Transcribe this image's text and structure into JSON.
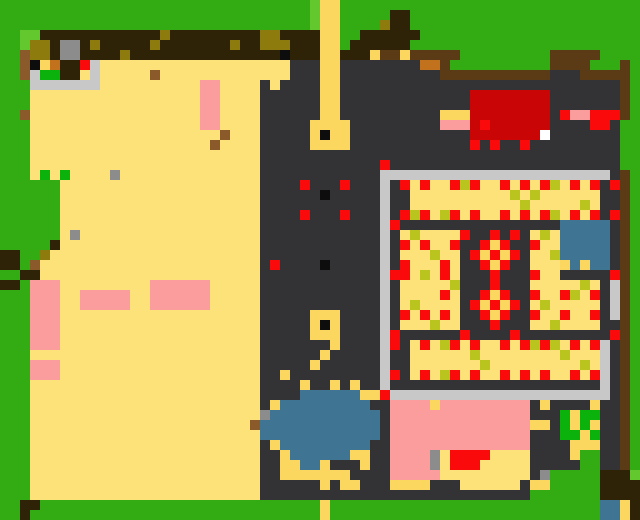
{
  "map": {
    "width_px": 640,
    "height_px": 520,
    "tile_size": 10,
    "cols": 64,
    "rows": 52,
    "palette": {
      "G": "#33ab13",
      "L": "#63c82e",
      "V": "#0cb20c",
      "T": "#fde179",
      "Y": "#fcd760",
      "D": "#333235",
      "B": "#2e2307",
      "b": "#5b3a16",
      "N": "#8a5a2b",
      "o": "#c2711d",
      "O": "#8d7b0d",
      "v": "#b9c41f",
      "P": "#fb9d9d",
      "R": "#fa0a0a",
      "r": "#c90505",
      "K": "#0d0d0d",
      "S": "#c8c8c8",
      "s": "#8c8c8c",
      "U": "#3f7492",
      "W": "#ffffff"
    },
    "legend": {
      "G": "grass",
      "L": "light-grass",
      "V": "bright-green-bush",
      "T": "sand-field",
      "Y": "yellow-path",
      "D": "dark-plaza-ground",
      "B": "dark-brown-wood",
      "b": "brown-fence",
      "N": "brown-debris",
      "o": "orange-crate",
      "O": "olive-thatch",
      "v": "olive-crop-speckle",
      "P": "pink-roof",
      "R": "red-marker",
      "r": "red-roof-building",
      "K": "black-marker",
      "S": "silver-wall",
      "s": "gray-stone",
      "U": "water",
      "W": "white-dot"
    },
    "rows_rle": [
      "G31 L Y2 G30",
      "G31 L Y2 G5 B2 G23",
      "G31 L Y2 G4 O B2 G23",
      "G2 L2 B12 O B9 O2 B4 Y2 G2 B6 G22",
      "G2 L O2 B s2 B O B5 O B7 O B2 O3 B3 Y2 G B6 G23",
      "G2 N O2 B s2 B4 O B15 K B3 Y2 B3 Y b2 Y b5 G9 b5 G4",
      "G2 N K Y o B2 R S T19 D3 Y2 D8 o2 b G10 b4 G3 b G",
      "G2 N S V2 B2 T S T5 N T13 D3 Y2 D10 b11 D3 b5 G",
      "G3 S7 T10 P2 T4 D T D4 Y2 D28 b G",
      "G3 T17 P2 T4 D6 Y2 D13 r8 D7 b G",
      "G3 T17 P2 T4 D6 Y2 D13 r8 D7 b G",
      "G2 N T17 P2 T4 D6 Y2 D10 Y3 r8 D R P2 R3 b G",
      "G3 T17 P2 T4 D5 Y4 D9 P3 r R r6 D4 R2 D G2",
      "G3 T19 N T3 D5 Y K Y2 D12 r7 W D7 G2",
      "G3 T18 N T4 D5 Y4 D12 R D R D2 R D9 G2",
      "G3 T23 D36 G2",
      "G3 T23 D12 R D23 G2",
      "G3 T V T V T4 s T14 D12 S23 D b G",
      "G6 T20 D4 R D3 R D3 S D R T R T2 R v R T2 R T R T R v T R T R D R b G",
      "G6 T20 D6 K D5 S D2 T10 v T v T6 D2 b G",
      "G6 T20 D12 S D2 T11 v T5 v T D2 b G",
      "G6 T20 D4 R D3 R D3 S D R v R T v R T R T2 R T R T R v T R T R D R b G",
      "G6 T20 D12 S R D16 U5 D b G",
      "G6 T s T18 D12 S D T v T4 R D2 R D R D T v T U5 D b G",
      "G5 B T20 D12 S D R T R T2 R D2 R Y R D2 R T2 U5 D b G",
      "B2 G2 O T21 D12 S D T3 v T2 D R Y R Y R D T2 v U5 D b G",
      "B2 G N T22 D R D4 K D5 S D R T3 R T D2 R Y R D2 T3 Y U Y U2 D b G",
      "G2 B2 T22 D12 S R R T v T R T D3 R D3 R T2 D5 R b G",
      "B2 G P3 T9 P6 T5 D12 S D T5 v D3 R D3 T5 v T D S b G",
      "G3 P3 T2 P5 T2 P6 T5 D12 S D T4 R T D2 R Y R D2 R T2 R v T R D S b G",
      "G3 P3 T2 P5 T2 P6 T5 D12 S D T v T4 D R Y R Y R D T v T5 D S b G",
      "G3 P3 T20 D5 Y3 D4 S D R T R T R T D2 R Y R D2 R T2 R T2 R D S b G",
      "G3 P3 T20 D5 Y K Y D4 S D T3 v T2 D3 R D3 T2 v T4 D2 b G",
      "G3 P3 T20 D5 Y3 D4 S R D6 R D4 R D9 R b G",
      "G3 P3 T20 D7 Y D4 S R D T R T v R T R T2 R T R v R v T R T R S D b G",
      "G3 T23 D6 Y D5 S D2 T6 v T8 v T3 S D b G",
      "G3 P3 T20 D5 Y D6 S D2 T7 v T9 v T S D b G",
      "G3 P3 T20 D2 Y D9 S R D T R T v R T R T2 R T R T R T2 R T R S D b G",
      "G3 T23 D4 Y D2 Y D Y D2 S D21 S D b G",
      "G3 T23 D4 U6 Y2 R S22 D b G",
      "G3 T23 D Y U9 D2 P4 Y P9 D Y D4 Y D2 b G",
      "G3 T23 s U11 D P14 D3 V Y V2 D2 b G",
      "G3 T22 N U12 D P14 Y2 D V Y V Y D2 b G",
      "G3 T23 U12 D P14 D3 V2 Y V D2 b G",
      "G3 T23 D Y U9 D2 P14 D4 Y3 D2 b G",
      "G3 T23 D2 Y U6 Y2 D2 P4 s T R4 T4 D4 Y G2 D2 b G",
      "G3 T23 D2 Y2 U2 Y D3 Y D2 P4 s T R3 T5 D5 G2 D2 b G",
      "G3 T23 D2 Y7 D4 P5 T9 D s G5 B3 L",
      "G3 T23 D6 Y D Y2 D3 Y4 D3 T6 D Y2 G5 B4",
      "G3 T23 D27 G7 B4",
      "G2 B2 G28 Y G27 U2 Y B",
      "G2 B G29 Y G27 U2 Y B"
    ],
    "features": [
      {
        "name": "sand-farm-field",
        "approx_px": [
          30,
          60,
          260,
          495
        ]
      },
      {
        "name": "top-dirt-ridge",
        "approx_px": [
          40,
          30,
          320,
          63
        ]
      },
      {
        "name": "stone-pen",
        "approx_px": [
          30,
          60,
          100,
          90
        ]
      },
      {
        "name": "vertical-footpath",
        "approx_px": [
          320,
          0,
          340,
          145
        ]
      },
      {
        "name": "path-waypoint-square-upper",
        "approx_px": [
          312,
          120,
          345,
          145
        ]
      },
      {
        "name": "path-waypoint-square-lower",
        "approx_px": [
          312,
          310,
          337,
          335
        ]
      },
      {
        "name": "red-black-marker-diamond",
        "approx_px": [
          295,
          175,
          353,
          218
        ]
      },
      {
        "name": "red-roof-building",
        "approx_px": [
          472,
          88,
          545,
          133
        ]
      },
      {
        "name": "red-pink-stall",
        "approx_px": [
          560,
          112,
          623,
          130
        ]
      },
      {
        "name": "walled-market-compound",
        "approx_px": [
          383,
          158,
          617,
          400
        ]
      },
      {
        "name": "crop-beds-with-red-dots",
        "approx_px": [
          400,
          177,
          600,
          378
        ]
      },
      {
        "name": "red-yellow-checker-diamonds",
        "approx_px": [
          465,
          226,
          520,
          337
        ]
      },
      {
        "name": "blue-stall-roof",
        "approx_px": [
          560,
          223,
          605,
          272
        ]
      },
      {
        "name": "pond",
        "approx_px": [
          258,
          393,
          377,
          478
        ]
      },
      {
        "name": "pink-roof-houses-left",
        "approx_px": [
          32,
          278,
          208,
          432
        ]
      },
      {
        "name": "pink-building-bottom-right",
        "approx_px": [
          392,
          397,
          528,
          480
        ]
      },
      {
        "name": "bush-patch-bottom-right",
        "approx_px": [
          560,
          407,
          600,
          442
        ]
      },
      {
        "name": "brown-fences-top-right",
        "approx_px": [
          420,
          50,
          632,
          117
        ]
      },
      {
        "name": "tree-trunk-bottom-right",
        "approx_px": [
          600,
          472,
          640,
          520
        ]
      }
    ]
  }
}
